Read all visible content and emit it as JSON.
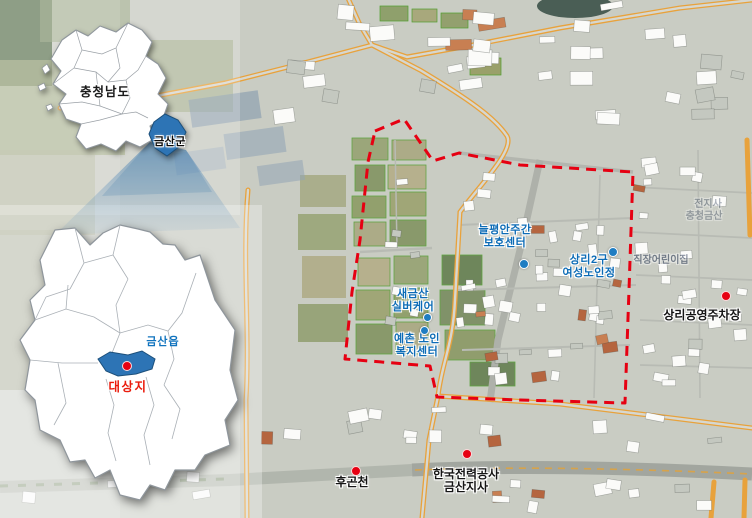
{
  "insets": {
    "province": {
      "label": "충청남도",
      "highlight_label": "금산군"
    },
    "county": {
      "town_label": "금산읍",
      "site_label": "대상지"
    }
  },
  "site_labels": [
    {
      "id": "neulpyeongan-daycare",
      "lines": [
        "늘평안주간",
        "보호센터"
      ]
    },
    {
      "id": "sangni2gu-senior-hall",
      "lines": [
        "상리2구",
        "여성노인정"
      ]
    },
    {
      "id": "saegeumsan-silvercare",
      "lines": [
        "새금산",
        "실버케어"
      ]
    },
    {
      "id": "yechon-welfare-center",
      "lines": [
        "예촌 노인",
        "복지센터"
      ]
    }
  ],
  "poi_labels": [
    {
      "id": "sangni-public-parking",
      "text": "상리공영주차장"
    },
    {
      "id": "hugoncheon",
      "text": "후곤천"
    },
    {
      "id": "kepco-geumsan",
      "lines": [
        "한국전력공사",
        "금산지사"
      ]
    }
  ],
  "faint_labels": [
    {
      "id": "basemap-text-1",
      "text": "전지사"
    },
    {
      "id": "basemap-text-2",
      "text": "충청금산"
    },
    {
      "id": "basemap-text-3",
      "text": "직장어린이집"
    }
  ],
  "colors": {
    "boundary_red": "#e60012",
    "marker_red": "#e60012",
    "marker_blue": "#1f7dc2",
    "highlight_blue": "#2d74b5",
    "label_blue": "#0d6cb6",
    "site_label_red": "#ea1c0d",
    "main_road_orange": "#e8a23c"
  }
}
